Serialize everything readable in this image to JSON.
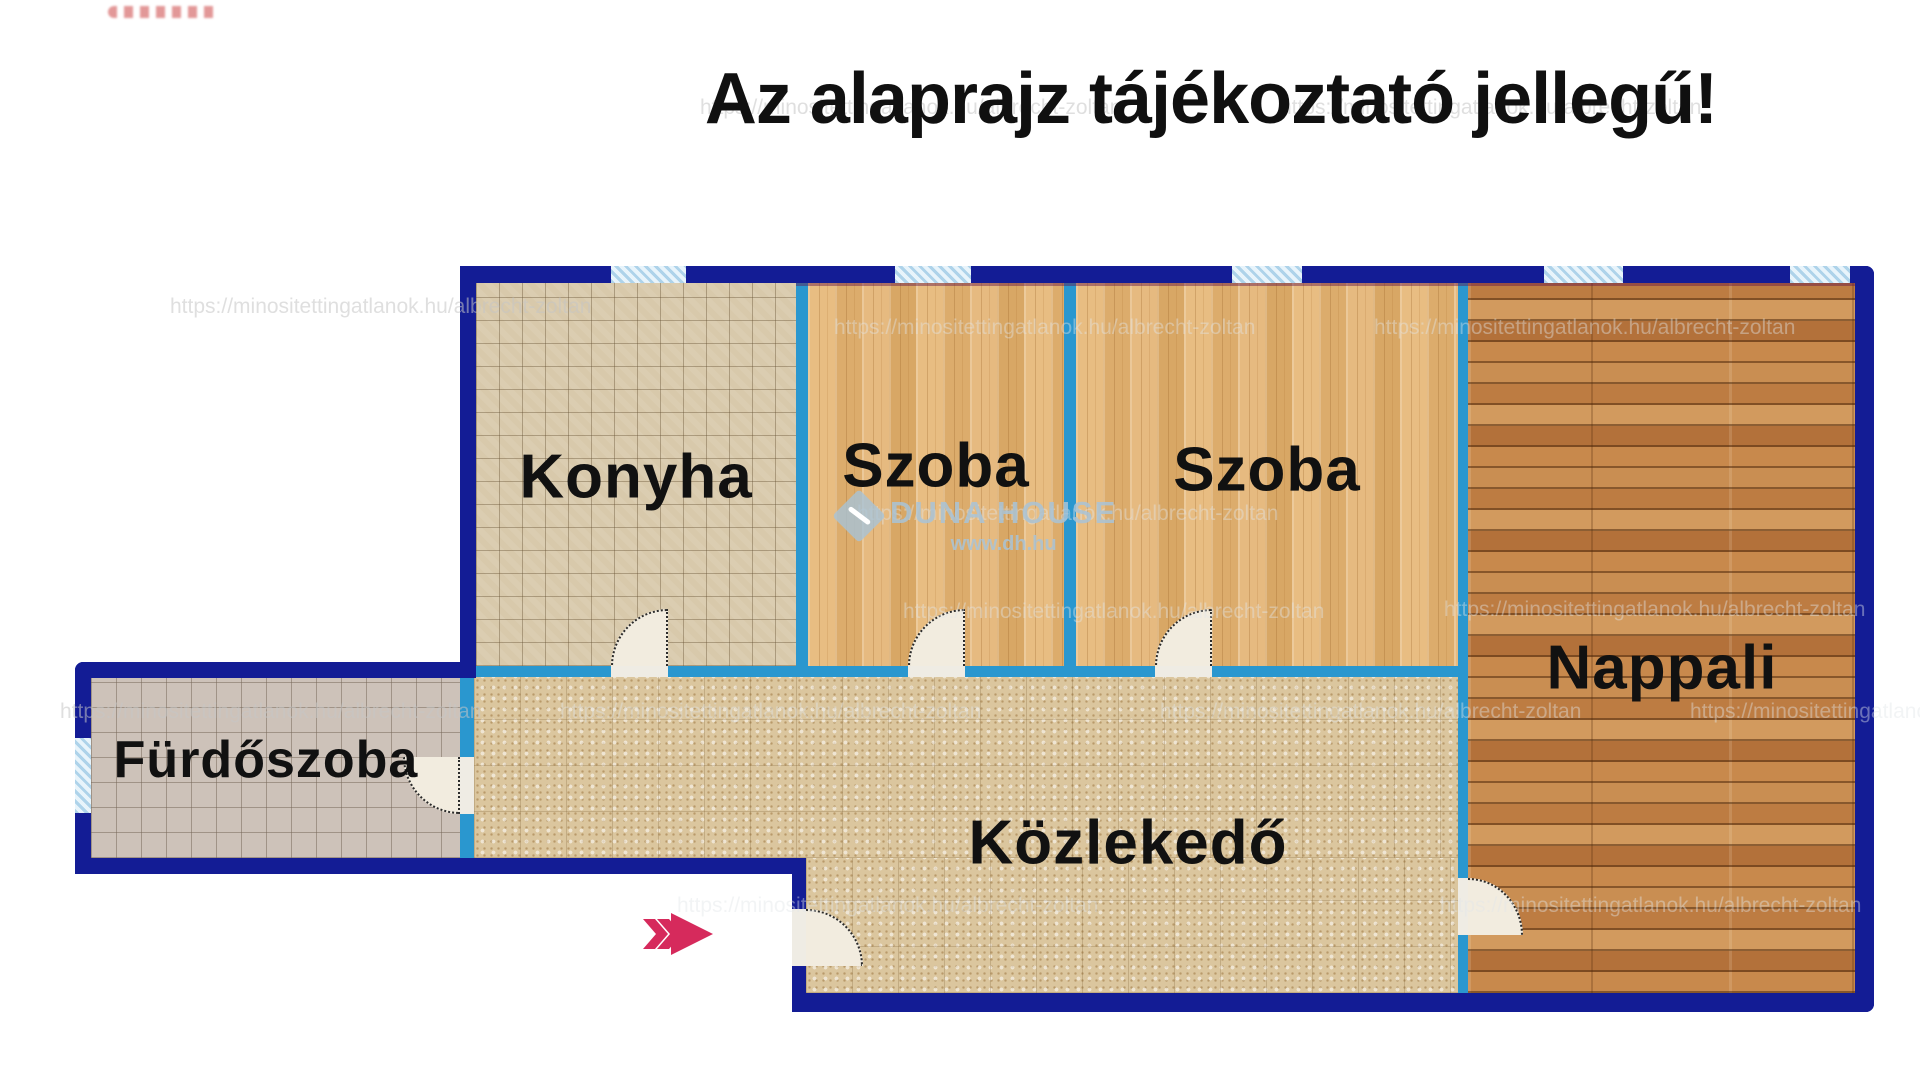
{
  "title": "Az alaprajz tájékoztató jellegű!",
  "rooms": [
    {
      "id": "kitchen",
      "label": "Konyha"
    },
    {
      "id": "room1",
      "label": "Szoba"
    },
    {
      "id": "room2",
      "label": "Szoba"
    },
    {
      "id": "living",
      "label": "Nappali"
    },
    {
      "id": "bathroom",
      "label": "Fürdőszoba"
    },
    {
      "id": "hallway",
      "label": "Közlekedő"
    }
  ],
  "watermarks": {
    "url": "https://minositettingatlanok.hu/albrecht-zoltan",
    "agency": "DUNA HOUSE",
    "agency_url": "www.dh.hu"
  },
  "colors": {
    "wall_outer": "#131c95",
    "wall_inner": "#2a97cf",
    "window_fill": "#e8f4fb",
    "window_stripe": "#aed3ea",
    "floor_kitchen": "#d8c9ab",
    "floor_bathroom": "#cdc2b9",
    "floor_room": "#e3b77c",
    "floor_living": "#c08146",
    "floor_hall": "#dbc69e",
    "door_fill": "#f2ecdf",
    "arrow": "#d62a5c",
    "text": "#111111"
  }
}
